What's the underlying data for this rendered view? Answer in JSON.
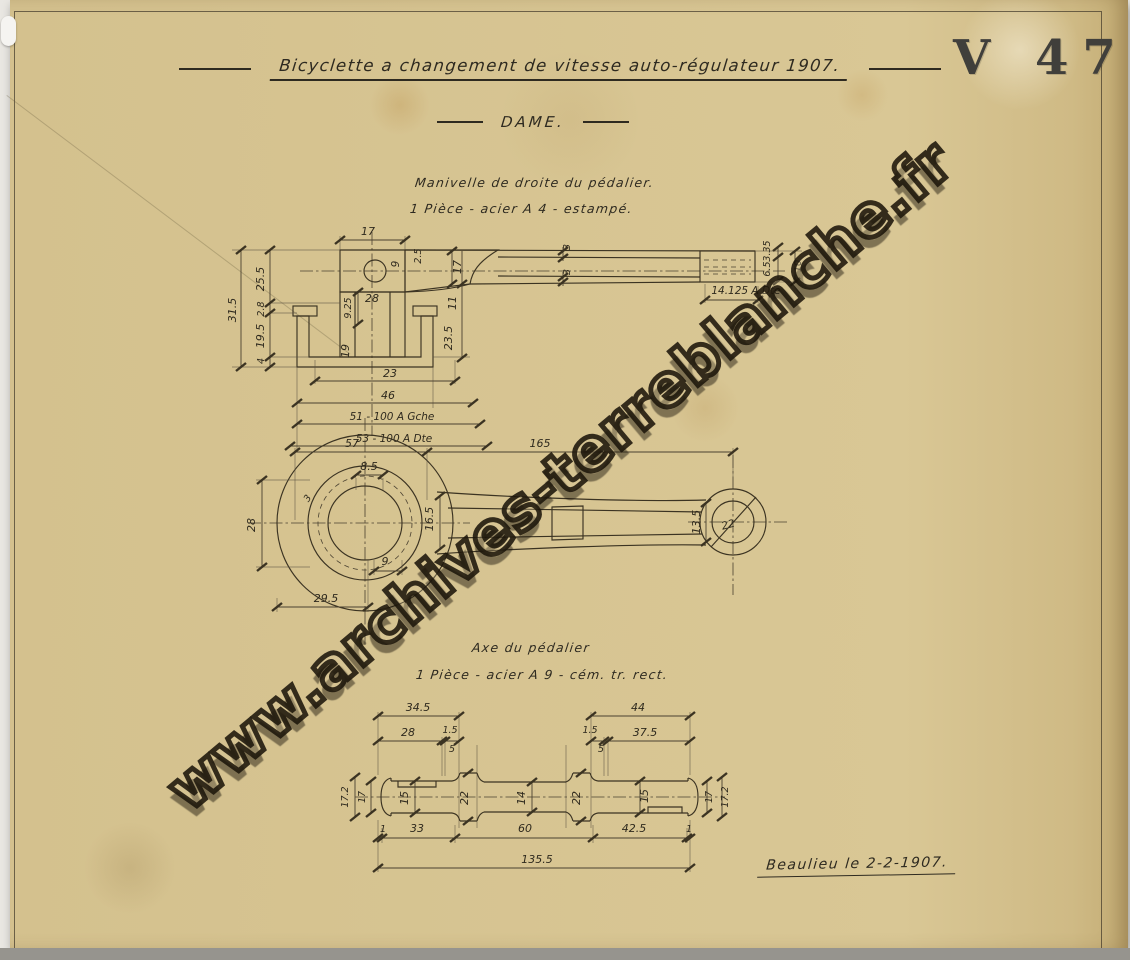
{
  "header": {
    "title": "Bicyclette a changement de vitesse auto-régulateur 1907.",
    "subtitle": "DAME.",
    "plate_code": "V 47"
  },
  "watermark": "www.archives-terreblanche.fr",
  "signature": "Beaulieu le 2-2-1907.",
  "colors": {
    "paper": "#d9c795",
    "ink": "#2e2a20"
  },
  "crank": {
    "caption1": "Manivelle de droite du pédalier.",
    "caption2": "1 Pièce - acier A 4 - estampé.",
    "section_dims": {
      "boss_top": "17",
      "hole": "9",
      "lip": "2.5",
      "arm_root": "17",
      "web_a": "3",
      "web_b": "3",
      "tip_a": "3.35",
      "tip_b": "6.5",
      "tip_c": "10",
      "thread": "14.125 A Dte",
      "drop_a": "11",
      "drop_b": "23.5",
      "col_a": "9.25",
      "col_b": "28",
      "bore": "19",
      "cup_inner": "23",
      "cup_outer": "46",
      "left_note": "51 - 100 A Gche",
      "right_note": "53 - 100 A Dte",
      "h_total": "31.5",
      "h_a": "25.5",
      "h_b": "2.8",
      "h_c": "19.5",
      "h_d": "4"
    },
    "front_dims": {
      "hub": "57",
      "length": "165",
      "key": "8.5",
      "fillet": "3",
      "hub_h": "28",
      "arm_root": "16.5",
      "boss": "9",
      "offset": "29.5",
      "arm_end": "13.5",
      "eye": "22"
    }
  },
  "axle": {
    "caption1": "Axe du pédalier",
    "caption2": "1 Pièce - acier A 9 - cém. tr. rect.",
    "dims": {
      "left_len": "34.5",
      "right_len": "44",
      "l28": "28",
      "l15": "1.5",
      "l5": "5",
      "r15": "1.5",
      "r5": "5",
      "r375": "37.5",
      "dl172": "17.2",
      "dl17": "17",
      "dj15l": "15",
      "df22l": "22",
      "dc14": "14",
      "df22r": "22",
      "dj15r": "15",
      "dr17": "17",
      "dr172": "17.2",
      "b1l": "1",
      "b33": "33",
      "b60": "60",
      "b425": "42.5",
      "b1r": "1",
      "total": "135.5"
    }
  }
}
